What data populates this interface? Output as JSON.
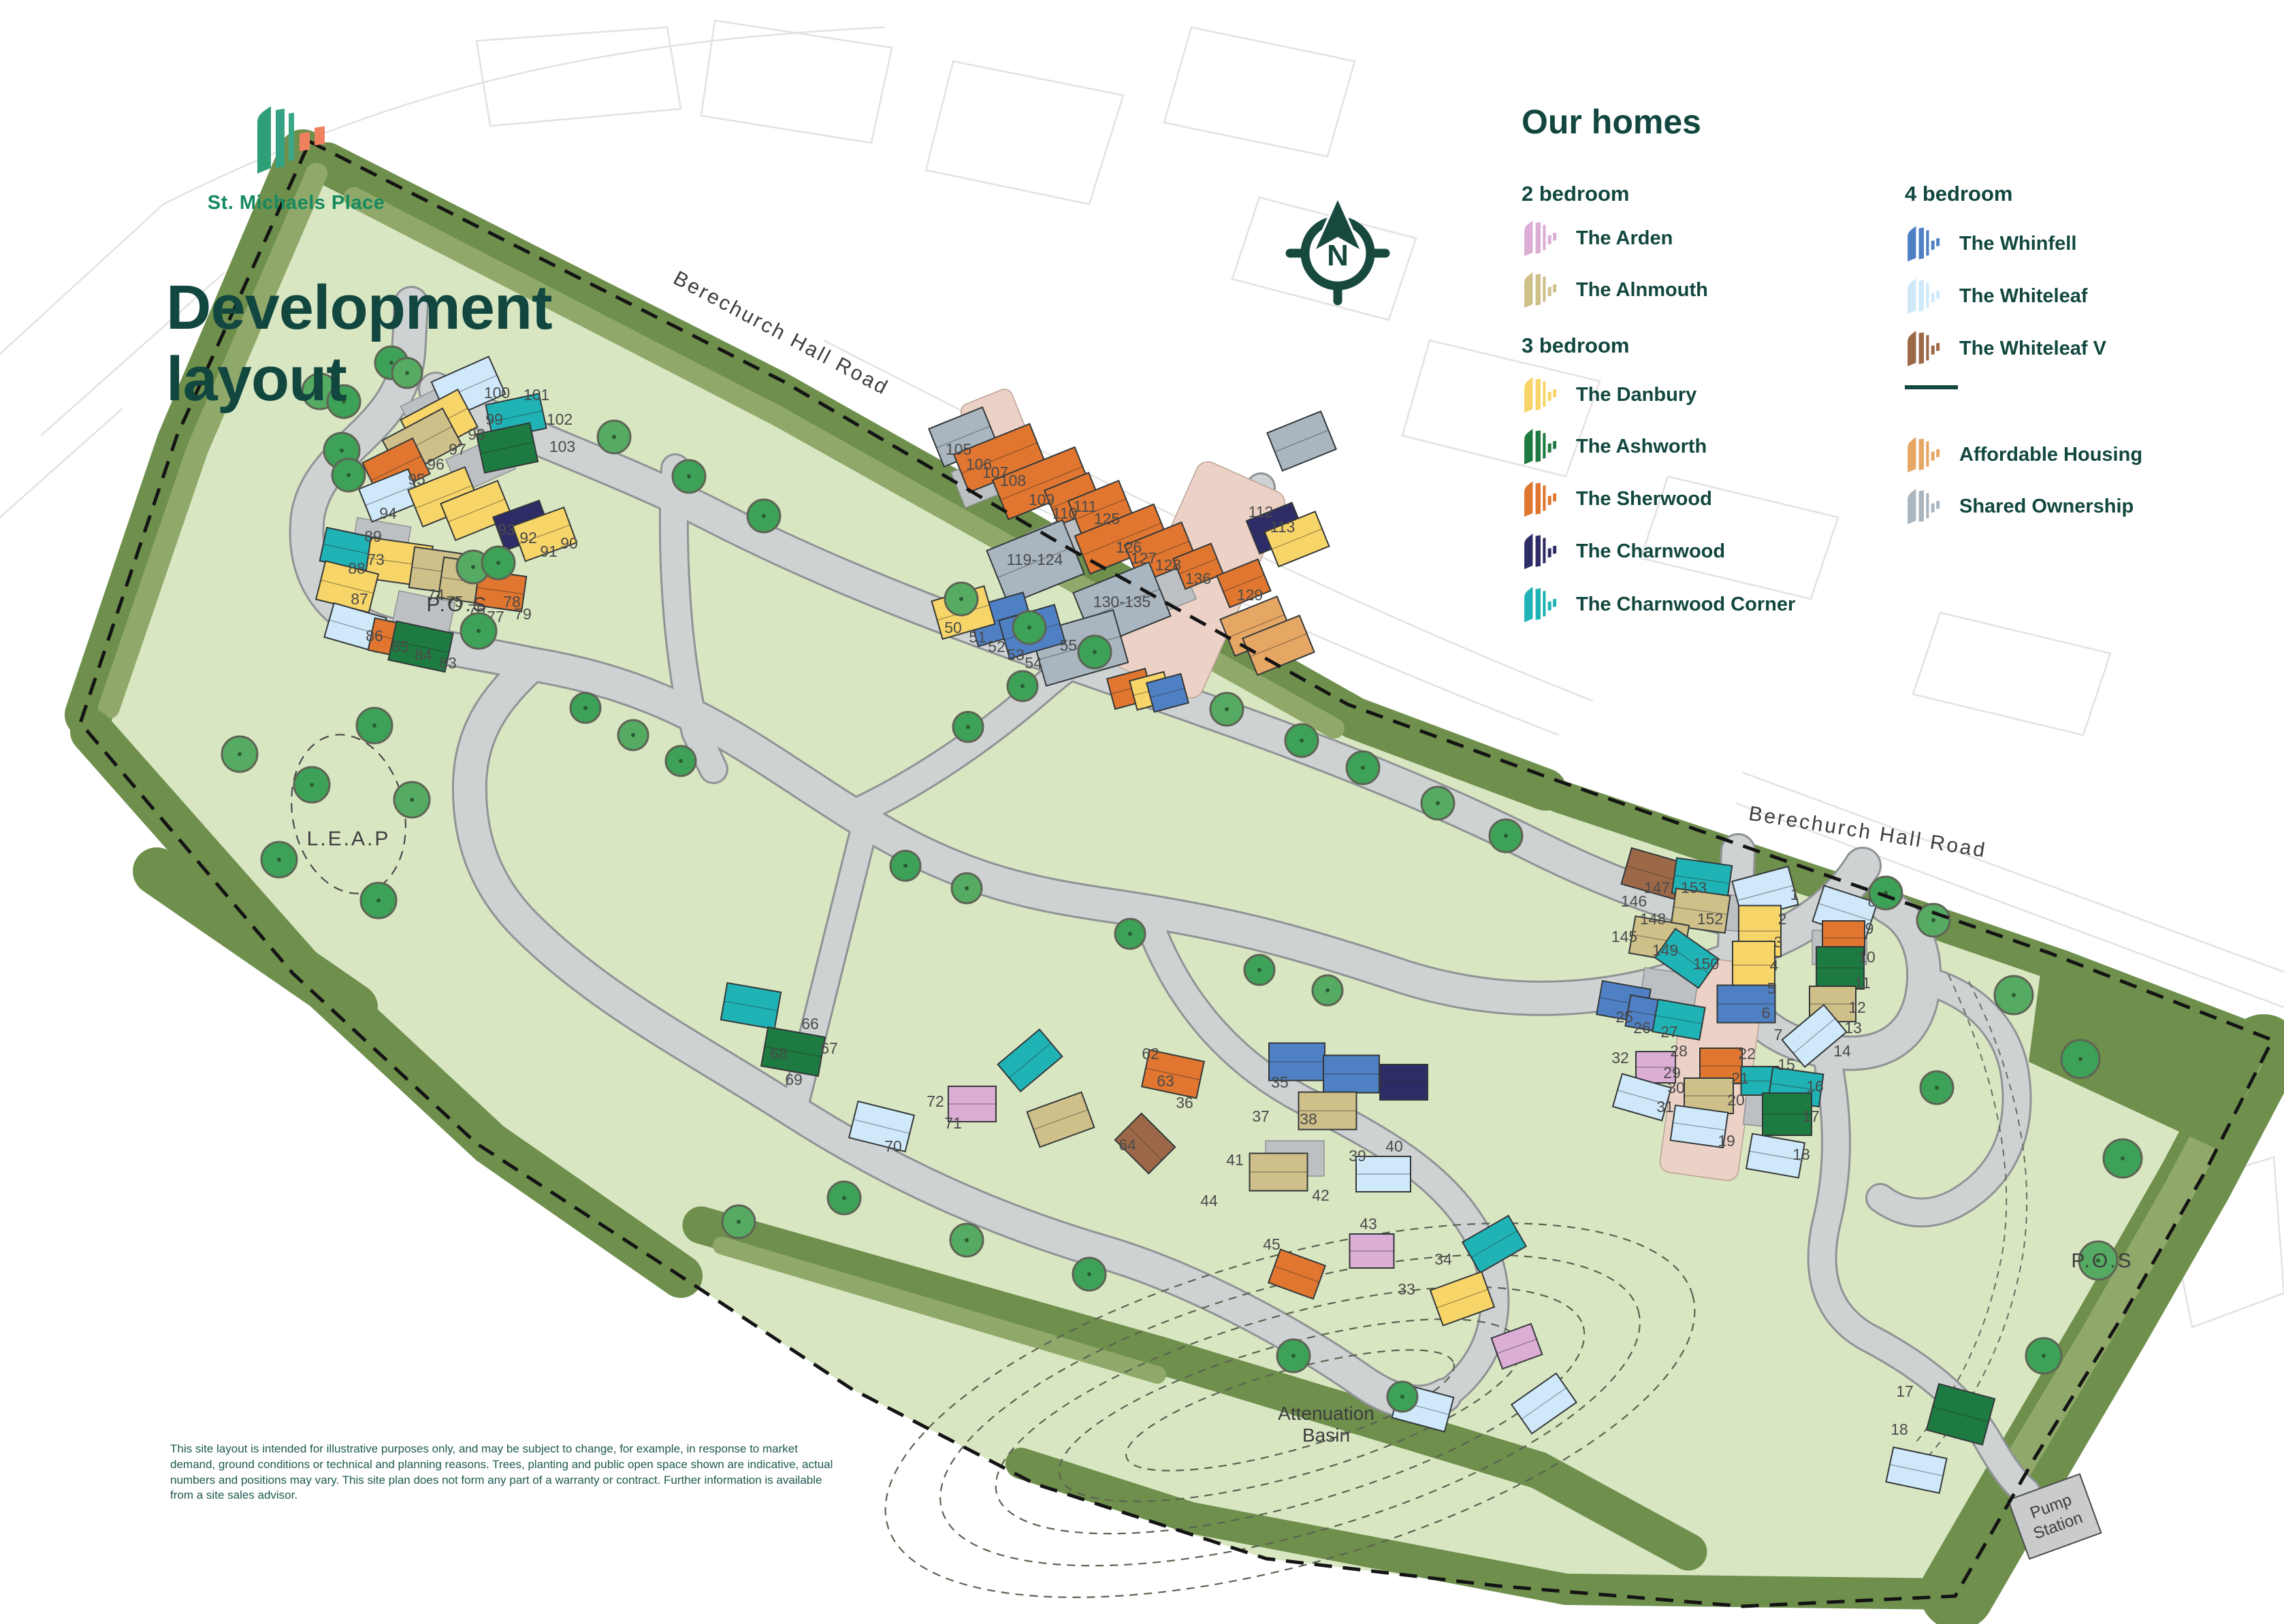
{
  "brand": {
    "name": "St. Michaels Place",
    "title_line1": "Development",
    "title_line2": "layout"
  },
  "legend": {
    "heading": "Our homes",
    "col1": [
      {
        "kind": "header",
        "label": "2 bedroom"
      },
      {
        "kind": "item",
        "key": "ar",
        "label": "The Arden"
      },
      {
        "kind": "item",
        "key": "al",
        "label": "The Alnmouth"
      },
      {
        "kind": "header",
        "label": "3 bedroom"
      },
      {
        "kind": "item",
        "key": "da",
        "label": "The Danbury"
      },
      {
        "kind": "item",
        "key": "as",
        "label": "The Ashworth"
      },
      {
        "kind": "item",
        "key": "sh",
        "label": "The Sherwood"
      },
      {
        "kind": "item",
        "key": "ch",
        "label": "The Charnwood"
      },
      {
        "kind": "item",
        "key": "cc",
        "label": "The Charnwood Corner"
      }
    ],
    "col2": [
      {
        "kind": "header",
        "label": "4 bedroom"
      },
      {
        "kind": "item",
        "key": "wf",
        "label": "The Whinfell"
      },
      {
        "kind": "item",
        "key": "wl",
        "label": "The Whiteleaf"
      },
      {
        "kind": "item",
        "key": "wv",
        "label": "The Whiteleaf V"
      },
      {
        "kind": "divider"
      },
      {
        "kind": "item",
        "key": "af",
        "label": "Affordable Housing"
      },
      {
        "kind": "item",
        "key": "so",
        "label": "Shared Ownership"
      }
    ]
  },
  "colors": {
    "accent_teal": "#11473f",
    "brand_green": "#168a60",
    "logo_green": "#2f9f77",
    "logo_orange": "#f0815f",
    "site_green": "#d9e6c2",
    "belt_green": "#6f8f4d",
    "belt_green_light": "#90a96a",
    "road_gray": "#cfd2d3",
    "plaza_pink": "#ecd2c6",
    "house_types": {
      "ar": "#dcaed6",
      "al": "#cfc089",
      "da": "#f8d568",
      "as": "#1d7a40",
      "sh": "#e0762f",
      "ch": "#2e2c66",
      "cc": "#1fb3b6",
      "wf": "#4f80c4",
      "wl": "#cfe9fa",
      "wv": "#9d6847",
      "af": "#e6a765",
      "so": "#a9b6c0"
    }
  },
  "map_labels": {
    "road1": "Berechurch Hall Road",
    "road2": "Berechurch Hall Road",
    "pos1": "P.O.S",
    "pos2": "P.O.S",
    "leap": "L.E.A.P",
    "attenuation1": "Attenuation",
    "attenuation2": "Basin",
    "pump1": "Pump",
    "pump2": "Station",
    "compass_n": "N"
  },
  "disclaimer": "This site layout is intended for illustrative purposes only, and may be subject to change, for example, in response to market demand, ground conditions or technical and planning reasons. Trees, planting and public open space shown are indicative, actual numbers and positions may vary. This site plan does not form any part of a warranty or contract. Further information is available from a site sales advisor.",
  "houses": [
    [
      688,
      570,
      92,
      60,
      -24,
      "wl"
    ],
    [
      645,
      622,
      95,
      62,
      -28,
      "da"
    ],
    [
      758,
      612,
      80,
      52,
      -12,
      "cc"
    ],
    [
      620,
      650,
      100,
      60,
      -28,
      "al"
    ],
    [
      745,
      658,
      80,
      58,
      -12,
      "as"
    ],
    [
      582,
      688,
      82,
      58,
      -26,
      "sh"
    ],
    [
      573,
      728,
      78,
      52,
      -22,
      "wl"
    ],
    [
      652,
      730,
      90,
      58,
      -22,
      "da"
    ],
    [
      700,
      750,
      90,
      58,
      -22,
      "da"
    ],
    [
      767,
      772,
      72,
      52,
      -20,
      "ch"
    ],
    [
      800,
      785,
      80,
      55,
      -20,
      "da"
    ],
    [
      515,
      808,
      82,
      50,
      12,
      "cc"
    ],
    [
      586,
      826,
      92,
      60,
      8,
      "da"
    ],
    [
      510,
      862,
      80,
      58,
      14,
      "da"
    ],
    [
      652,
      840,
      95,
      60,
      8,
      "al"
    ],
    [
      695,
      855,
      95,
      60,
      8,
      "al"
    ],
    [
      735,
      868,
      70,
      52,
      8,
      "sh"
    ],
    [
      522,
      922,
      80,
      52,
      16,
      "wl"
    ],
    [
      576,
      938,
      62,
      48,
      12,
      "sh"
    ],
    [
      618,
      950,
      85,
      58,
      12,
      "as"
    ],
    [
      1415,
      642,
      85,
      60,
      -22,
      "so"
    ],
    [
      1468,
      673,
      120,
      60,
      -22,
      "sh"
    ],
    [
      1530,
      710,
      130,
      62,
      -22,
      "sh"
    ],
    [
      1577,
      733,
      70,
      55,
      -22,
      "sh"
    ],
    [
      1617,
      748,
      80,
      58,
      -22,
      "sh"
    ],
    [
      1648,
      792,
      125,
      60,
      -22,
      "sh"
    ],
    [
      1705,
      812,
      90,
      60,
      -22,
      "sh"
    ],
    [
      1760,
      832,
      60,
      48,
      -22,
      "sh"
    ],
    [
      1827,
      857,
      65,
      50,
      -22,
      "sh"
    ],
    [
      1912,
      648,
      85,
      60,
      -22,
      "so"
    ],
    [
      1521,
      826,
      120,
      85,
      -22,
      "so"
    ],
    [
      1648,
      888,
      120,
      85,
      -22,
      "so"
    ],
    [
      1586,
      952,
      125,
      80,
      -16,
      "so"
    ],
    [
      1470,
      910,
      85,
      58,
      -16,
      "wf"
    ],
    [
      1516,
      928,
      85,
      58,
      -16,
      "wf"
    ],
    [
      1415,
      900,
      80,
      58,
      -16,
      "da"
    ],
    [
      1874,
      776,
      72,
      52,
      -22,
      "ch"
    ],
    [
      1905,
      792,
      80,
      55,
      -22,
      "da"
    ],
    [
      1845,
      920,
      90,
      58,
      -22,
      "af"
    ],
    [
      1878,
      948,
      90,
      58,
      -22,
      "af"
    ],
    [
      1660,
      1012,
      58,
      46,
      -15,
      "sh"
    ],
    [
      1690,
      1015,
      52,
      44,
      -15,
      "da"
    ],
    [
      1715,
      1018,
      52,
      44,
      -15,
      "wf"
    ],
    [
      1103,
      1478,
      80,
      55,
      10,
      "cc"
    ],
    [
      1165,
      1545,
      85,
      58,
      10,
      "as"
    ],
    [
      1295,
      1655,
      85,
      55,
      14,
      "wl"
    ],
    [
      1428,
      1622,
      70,
      52,
      0,
      "ar"
    ],
    [
      1513,
      1558,
      80,
      52,
      -40,
      "cc"
    ],
    [
      1558,
      1645,
      85,
      55,
      -20,
      "al"
    ],
    [
      1723,
      1578,
      82,
      55,
      12,
      "sh"
    ],
    [
      1682,
      1680,
      70,
      55,
      45,
      "wv"
    ],
    [
      1905,
      1560,
      82,
      55,
      0,
      "wf"
    ],
    [
      1985,
      1578,
      82,
      55,
      0,
      "wf"
    ],
    [
      2062,
      1590,
      70,
      52,
      0,
      "ch"
    ],
    [
      1950,
      1632,
      85,
      55,
      0,
      "al"
    ],
    [
      1878,
      1722,
      85,
      55,
      0,
      "al"
    ],
    [
      2032,
      1725,
      80,
      52,
      0,
      "wl"
    ],
    [
      2015,
      1838,
      65,
      50,
      0,
      "ar"
    ],
    [
      1905,
      1872,
      70,
      52,
      20,
      "sh"
    ],
    [
      2195,
      1828,
      78,
      52,
      -30,
      "cc"
    ],
    [
      2148,
      1908,
      80,
      55,
      -20,
      "da"
    ],
    [
      2228,
      1978,
      62,
      48,
      -20,
      "ar"
    ],
    [
      2090,
      2068,
      80,
      52,
      15,
      "wl"
    ],
    [
      2268,
      2062,
      80,
      52,
      -35,
      "wl"
    ],
    [
      2430,
      1284,
      85,
      55,
      16,
      "wv"
    ],
    [
      2500,
      1292,
      82,
      52,
      8,
      "cc"
    ],
    [
      2498,
      1338,
      80,
      55,
      8,
      "al"
    ],
    [
      2437,
      1380,
      80,
      55,
      10,
      "al"
    ],
    [
      2478,
      1408,
      78,
      52,
      35,
      "cc"
    ],
    [
      2593,
      1312,
      85,
      58,
      -15,
      "wl"
    ],
    [
      2585,
      1368,
      62,
      75,
      0,
      "da"
    ],
    [
      2576,
      1418,
      62,
      70,
      0,
      "da"
    ],
    [
      2565,
      1475,
      85,
      55,
      0,
      "wf"
    ],
    [
      2710,
      1340,
      82,
      55,
      18,
      "wl"
    ],
    [
      2708,
      1378,
      62,
      50,
      0,
      "sh"
    ],
    [
      2703,
      1422,
      70,
      62,
      0,
      "as"
    ],
    [
      2692,
      1475,
      68,
      52,
      0,
      "al"
    ],
    [
      2665,
      1522,
      80,
      52,
      -40,
      "wl"
    ],
    [
      2385,
      1472,
      72,
      50,
      10,
      "wf"
    ],
    [
      2422,
      1490,
      62,
      46,
      10,
      "wf"
    ],
    [
      2466,
      1498,
      70,
      48,
      10,
      "cc"
    ],
    [
      2432,
      1568,
      58,
      46,
      0,
      "ar"
    ],
    [
      2412,
      1612,
      75,
      50,
      16,
      "wl"
    ],
    [
      2528,
      1566,
      62,
      52,
      0,
      "sh"
    ],
    [
      2510,
      1610,
      72,
      52,
      0,
      "al"
    ],
    [
      2496,
      1655,
      78,
      52,
      8,
      "wl"
    ],
    [
      2585,
      1588,
      55,
      42,
      0,
      "cc"
    ],
    [
      2638,
      1597,
      75,
      48,
      8,
      "cc"
    ],
    [
      2625,
      1637,
      72,
      62,
      0,
      "as"
    ],
    [
      2608,
      1698,
      78,
      52,
      10,
      "wl"
    ],
    [
      2880,
      2078,
      85,
      70,
      15,
      "as"
    ],
    [
      2815,
      2160,
      80,
      52,
      12,
      "wl"
    ]
  ],
  "plot_labels": [
    [
      612,
      712,
      "95"
    ],
    [
      640,
      690,
      "96"
    ],
    [
      672,
      668,
      "97"
    ],
    [
      700,
      646,
      "98"
    ],
    [
      726,
      624,
      "99"
    ],
    [
      730,
      585,
      "100"
    ],
    [
      788,
      588,
      "101"
    ],
    [
      822,
      624,
      "102"
    ],
    [
      826,
      664,
      "103"
    ],
    [
      836,
      806,
      "90"
    ],
    [
      806,
      818,
      "91"
    ],
    [
      776,
      798,
      "92"
    ],
    [
      744,
      786,
      "93"
    ],
    [
      570,
      762,
      "94"
    ],
    [
      548,
      796,
      "89"
    ],
    [
      524,
      843,
      "88"
    ],
    [
      528,
      888,
      "87"
    ],
    [
      550,
      942,
      "86"
    ],
    [
      588,
      958,
      "85"
    ],
    [
      622,
      970,
      "84"
    ],
    [
      658,
      982,
      "83"
    ],
    [
      552,
      830,
      "73"
    ],
    [
      640,
      882,
      "74"
    ],
    [
      668,
      892,
      "75"
    ],
    [
      700,
      904,
      "76"
    ],
    [
      728,
      914,
      "77"
    ],
    [
      752,
      892,
      "78"
    ],
    [
      768,
      910,
      "79"
    ],
    [
      1408,
      668,
      "105"
    ],
    [
      1438,
      690,
      "106"
    ],
    [
      1462,
      702,
      "107"
    ],
    [
      1488,
      714,
      "108"
    ],
    [
      1530,
      742,
      "109"
    ],
    [
      1564,
      762,
      "110"
    ],
    [
      1594,
      752,
      "111"
    ],
    [
      1626,
      770,
      "125"
    ],
    [
      1658,
      812,
      "126"
    ],
    [
      1680,
      828,
      "127"
    ],
    [
      1716,
      838,
      "128"
    ],
    [
      1836,
      882,
      "129"
    ],
    [
      1760,
      858,
      "136"
    ],
    [
      1520,
      830,
      "119-124"
    ],
    [
      1648,
      892,
      "130-135"
    ],
    [
      1586,
      956,
      "55-61"
    ],
    [
      1400,
      930,
      "50"
    ],
    [
      1436,
      944,
      "51"
    ],
    [
      1464,
      958,
      "52"
    ],
    [
      1492,
      970,
      "53"
    ],
    [
      1518,
      982,
      "54"
    ],
    [
      1852,
      760,
      "112"
    ],
    [
      1884,
      782,
      "113"
    ],
    [
      1190,
      1512,
      "66"
    ],
    [
      1218,
      1548,
      "67"
    ],
    [
      1144,
      1556,
      "68"
    ],
    [
      1166,
      1594,
      "69"
    ],
    [
      1312,
      1692,
      "70"
    ],
    [
      1400,
      1658,
      "71"
    ],
    [
      1374,
      1626,
      "72"
    ],
    [
      1690,
      1556,
      "62"
    ],
    [
      1712,
      1596,
      "63"
    ],
    [
      1656,
      1690,
      "64"
    ],
    [
      1880,
      1598,
      "35"
    ],
    [
      1740,
      1628,
      "36"
    ],
    [
      1852,
      1648,
      "37"
    ],
    [
      1922,
      1652,
      "38"
    ],
    [
      1994,
      1706,
      "39"
    ],
    [
      2048,
      1692,
      "40"
    ],
    [
      1814,
      1712,
      "41"
    ],
    [
      1940,
      1764,
      "42"
    ],
    [
      2010,
      1806,
      "43"
    ],
    [
      1776,
      1772,
      "44"
    ],
    [
      1868,
      1836,
      "45"
    ],
    [
      2066,
      1902,
      "33"
    ],
    [
      2120,
      1858,
      "34"
    ],
    [
      2488,
      1312,
      "153"
    ],
    [
      2512,
      1358,
      "152"
    ],
    [
      2506,
      1424,
      "150"
    ],
    [
      2446,
      1404,
      "149"
    ],
    [
      2428,
      1358,
      "148"
    ],
    [
      2434,
      1312,
      "147"
    ],
    [
      2400,
      1332,
      "146"
    ],
    [
      2386,
      1384,
      "145"
    ],
    [
      2636,
      1322,
      "1"
    ],
    [
      2618,
      1358,
      "2"
    ],
    [
      2612,
      1392,
      "3"
    ],
    [
      2606,
      1426,
      "4"
    ],
    [
      2602,
      1460,
      "5"
    ],
    [
      2594,
      1496,
      "6"
    ],
    [
      2612,
      1528,
      "7"
    ],
    [
      2750,
      1332,
      "8"
    ],
    [
      2746,
      1372,
      "9"
    ],
    [
      2742,
      1414,
      "10"
    ],
    [
      2736,
      1452,
      "11"
    ],
    [
      2728,
      1488,
      "12"
    ],
    [
      2722,
      1518,
      "13"
    ],
    [
      2706,
      1552,
      "14"
    ],
    [
      2624,
      1572,
      "15"
    ],
    [
      2666,
      1604,
      "16"
    ],
    [
      2660,
      1648,
      "17"
    ],
    [
      2646,
      1704,
      "18"
    ],
    [
      2536,
      1684,
      "19"
    ],
    [
      2550,
      1624,
      "20"
    ],
    [
      2556,
      1592,
      "21"
    ],
    [
      2566,
      1556,
      "22"
    ],
    [
      2386,
      1502,
      "25"
    ],
    [
      2412,
      1518,
      "26"
    ],
    [
      2452,
      1524,
      "27"
    ],
    [
      2466,
      1552,
      "28"
    ],
    [
      2456,
      1584,
      "29"
    ],
    [
      2462,
      1606,
      "30"
    ],
    [
      2446,
      1634,
      "31"
    ],
    [
      2380,
      1562,
      "32"
    ],
    [
      2798,
      2052,
      "17"
    ],
    [
      2790,
      2108,
      "18"
    ]
  ],
  "trees": [
    [
      470,
      575,
      26
    ],
    [
      505,
      590,
      24
    ],
    [
      575,
      533,
      24
    ],
    [
      598,
      548,
      22
    ],
    [
      502,
      662,
      26
    ],
    [
      512,
      698,
      24
    ],
    [
      695,
      833,
      24
    ],
    [
      732,
      827,
      24
    ],
    [
      703,
      927,
      26
    ],
    [
      352,
      1108,
      26
    ],
    [
      550,
      1066,
      26
    ],
    [
      458,
      1153,
      26
    ],
    [
      605,
      1175,
      26
    ],
    [
      410,
      1263,
      26
    ],
    [
      556,
      1323,
      26
    ],
    [
      902,
      642,
      24
    ],
    [
      1012,
      700,
      24
    ],
    [
      1122,
      758,
      24
    ],
    [
      1412,
      880,
      24
    ],
    [
      1512,
      922,
      24
    ],
    [
      1608,
      958,
      24
    ],
    [
      1802,
      1042,
      24
    ],
    [
      1912,
      1088,
      24
    ],
    [
      2002,
      1128,
      24
    ],
    [
      2112,
      1180,
      24
    ],
    [
      2212,
      1228,
      24
    ],
    [
      860,
      1040,
      22
    ],
    [
      930,
      1080,
      22
    ],
    [
      1000,
      1118,
      22
    ],
    [
      1330,
      1272,
      22
    ],
    [
      1420,
      1305,
      22
    ],
    [
      1660,
      1372,
      22
    ],
    [
      1850,
      1425,
      22
    ],
    [
      1950,
      1455,
      22
    ],
    [
      1422,
      1068,
      22
    ],
    [
      1502,
      1008,
      22
    ],
    [
      2958,
      1462,
      28
    ],
    [
      3056,
      1556,
      28
    ],
    [
      3118,
      1702,
      28
    ],
    [
      3082,
      1852,
      28
    ],
    [
      3002,
      1992,
      26
    ],
    [
      2770,
      1312,
      24
    ],
    [
      2840,
      1352,
      24
    ],
    [
      2845,
      1598,
      24
    ],
    [
      1240,
      1760,
      24
    ],
    [
      1420,
      1822,
      24
    ],
    [
      1600,
      1872,
      24
    ],
    [
      1900,
      1992,
      24
    ],
    [
      1085,
      1795,
      24
    ],
    [
      2060,
      2052,
      22
    ]
  ]
}
